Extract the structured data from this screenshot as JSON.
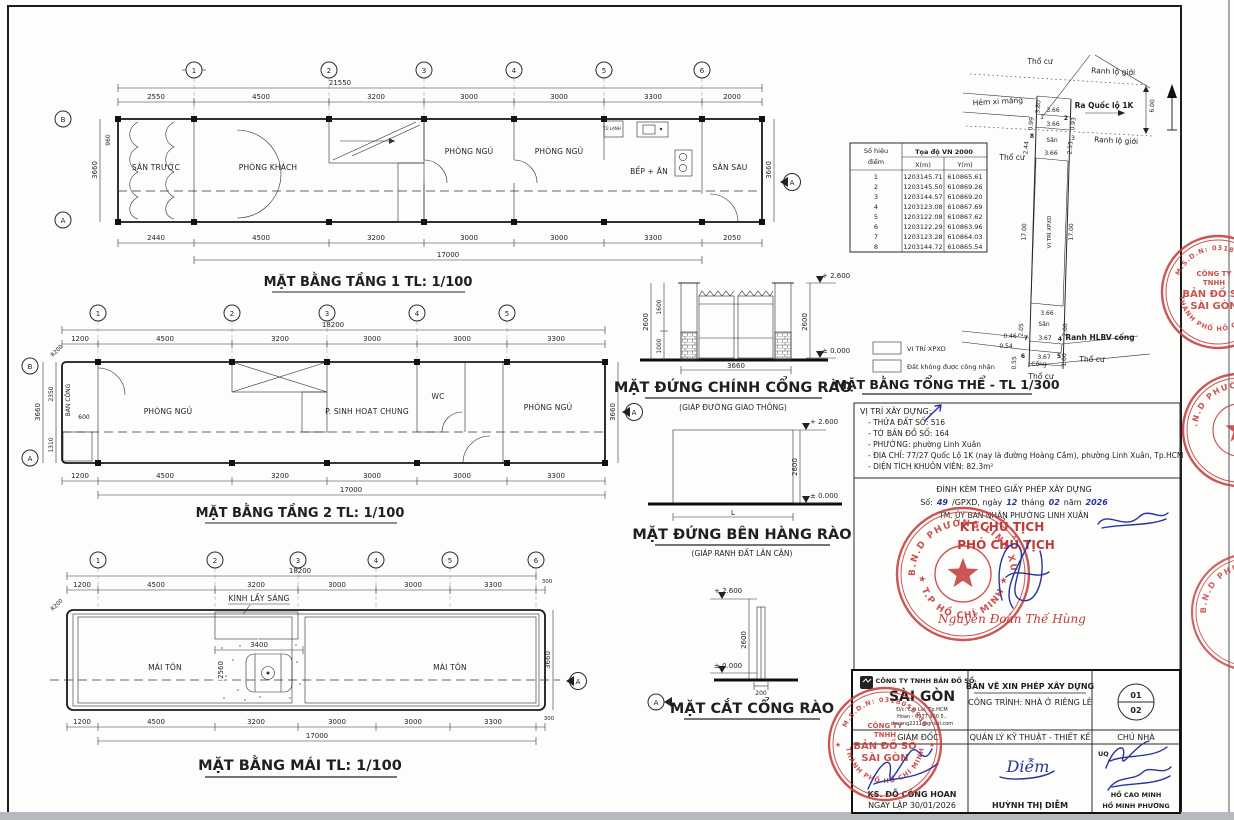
{
  "colors": {
    "stamp_red": "#c43f3f",
    "ink_blue": "#27349b",
    "paper": "#fdfdfb"
  },
  "plan1": {
    "title": "MẶT BẰNG TẦNG 1 TL: 1/100",
    "grid": [
      "1",
      "2",
      "3",
      "4",
      "5",
      "6"
    ],
    "left_bubbles": [
      "B",
      "A"
    ],
    "marker": "A",
    "overall_top": "21550",
    "dims_top": [
      "2550",
      "4500",
      "3200",
      "3000",
      "3000",
      "3300",
      "2000"
    ],
    "dims_bottom": [
      "2440",
      "4500",
      "3200",
      "3000",
      "3000",
      "3300",
      "2050"
    ],
    "overall_bottom": "17000",
    "dim_left_outer": "3660",
    "dim_left_inner": "960",
    "dim_right": "3660",
    "rooms": {
      "front_yard": "SÂN TRƯỚC",
      "living": "PHÒNG KHÁCH",
      "bed1": "PHÒNG NGỦ",
      "bed2": "PHÒNG NGỦ",
      "kitchen": "BẾP + ĂN",
      "back_yard": "SÂN SAU",
      "fridge": "TỦ LẠNH"
    }
  },
  "plan2": {
    "title": "MẶT BẰNG TẦNG 2 TL: 1/100",
    "grid": [
      "1",
      "2",
      "3",
      "4",
      "5"
    ],
    "left_bubbles": [
      "B",
      "A"
    ],
    "marker": "A",
    "overall_top": "18200",
    "dims_top": [
      "1200",
      "4500",
      "3200",
      "3000",
      "3000",
      "3300"
    ],
    "dims_bottom": [
      "1200",
      "4500",
      "3200",
      "3000",
      "3000",
      "3300"
    ],
    "overall_bottom": "17000",
    "dim_left_outer": "3660",
    "dim_left_a": "2350",
    "dim_left_b": "1310",
    "dim_600": "600",
    "r200": "R200",
    "dim_right": "3660",
    "rooms": {
      "balcony": "BAN CÔNG",
      "bed1": "PHÒNG NGỦ",
      "common": "P. SINH HOẠT CHUNG",
      "wc": "WC",
      "bed2": "PHÒNG NGỦ"
    }
  },
  "roof": {
    "title": "MẶT BẰNG MÁI TL: 1/100",
    "grid": [
      "1",
      "2",
      "3",
      "4",
      "5",
      "6"
    ],
    "marker": "A",
    "overall_top": "18200",
    "dims_top": [
      "1200",
      "4500",
      "3200",
      "3000",
      "3000",
      "3300",
      "300"
    ],
    "dims_bottom": [
      "1200",
      "4500",
      "3200",
      "3000",
      "3000",
      "3300",
      "300"
    ],
    "overall_bottom": "17000",
    "d3400": "3400",
    "d2560": "2560",
    "dim_right": "3660",
    "r200": "R200",
    "skylight": "KÍNH LẤY SÁNG",
    "mt_left": "MÁI TÔN",
    "mt_right": "MÁI TÔN"
  },
  "gate_front": {
    "title": "MẶT ĐỨNG CHÍNH CỔNG RÀO",
    "subtitle": "(GIÁP ĐƯỜNG GIAO THÔNG)",
    "lvl_top": "+ 2.600",
    "lvl_zero": "± 0.000",
    "d2600l": "2600",
    "d1600": "1600",
    "d1000": "1000",
    "d3660": "3660",
    "d2600r": "2600"
  },
  "fence_side": {
    "title": "MẶT ĐỨNG BÊN HÀNG RÀO",
    "subtitle": "(GIÁP RANH ĐẤT LÂN CẬN)",
    "lvl_top": "+ 2.600",
    "lvl_zero": "± 0.000",
    "d2600": "2600",
    "dL": "L"
  },
  "gate_section": {
    "title": "MẶT CẮT CỔNG RÀO",
    "lvl_top": "+ 2.600",
    "lvl_zero": "± 0.000",
    "d2600": "2600",
    "d200": "200"
  },
  "site": {
    "title": "MẶT BẰNG TỔNG THỂ - TL 1/300",
    "table": {
      "h_point": "Số hiệu",
      "h_point2": "điểm",
      "h_coord": "Tọa độ VN 2000",
      "h_x": "X(m)",
      "h_y": "Y(m)",
      "rows": [
        [
          "1",
          "1203145.71",
          "610865.61"
        ],
        [
          "2",
          "1203145.50",
          "610869.26"
        ],
        [
          "3",
          "1203144.57",
          "610869.20"
        ],
        [
          "4",
          "1203123.08",
          "610867.69"
        ],
        [
          "5",
          "1203122.08",
          "610867.62"
        ],
        [
          "6",
          "1203122.29",
          "610863.96"
        ],
        [
          "7",
          "1203123.28",
          "610864.03"
        ],
        [
          "8",
          "1203144.72",
          "610865.54"
        ]
      ]
    },
    "labels": {
      "tho_cu_top": "Thổ cư",
      "tho_cu_left": "Thổ cư",
      "tho_cu_bottom": "Thổ cư",
      "tho_cu_br": "Thổ cư",
      "ranh1": "Ranh lộ giới",
      "ranh2": "Ranh lộ giới",
      "hem": "Hẻm xi măng",
      "ra_ql": "Ra Quốc lộ 1K",
      "san_top": "Sân",
      "san_bottom": "Sân",
      "cong": "Cống",
      "ranh_hlbv": "Ranh HLBV cống",
      "xpxd_strip": "VI TRÍ XPXD"
    },
    "dims": {
      "d380": "3.80",
      "d366a": "3.66",
      "d366b": "3.66",
      "d366c": "3.66",
      "d366d": "3.66",
      "d099": "0.99",
      "d093": "0.93",
      "d244": "2.44",
      "d255": "2.55",
      "d600": "6.00",
      "d1700l": "17.00",
      "d1700r": "17.00",
      "d205": "2.05",
      "d200": "2.00",
      "d046": "0.46",
      "d367a": "3.67",
      "d054": "0.54",
      "d367b": "3.67",
      "d055": "0.55",
      "d100": "1.00"
    },
    "points": {
      "p1": "1",
      "p2": "2",
      "p3": "3",
      "p8": "8",
      "p7": "7",
      "p4": "4",
      "p6": "6",
      "p5": "5"
    },
    "legend": {
      "xpxd": "VI TRÍ XPXD",
      "no_recog": "Đất không được công nhận"
    }
  },
  "info": {
    "heading": "VỊ TRÍ XÂY DỰNG:",
    "l1": "- THỬA ĐẤT SỐ: 516",
    "l2": "- TỜ BẢN ĐỒ SỐ: 164",
    "l3": "- PHƯỜNG: phường Linh Xuân",
    "l4": "- ĐỊA CHỈ: 77/27 Quốc Lộ 1K (nay là đường Hoàng Cầm), phường Linh Xuân, Tp.HCM",
    "l5": "- DIỆN TÍCH KHUÔN VIÊN: 82.3m²"
  },
  "permit": {
    "l1": "ĐÍNH KÈM THEO GIẤY PHÉP XÂY DỰNG",
    "so": "Số:",
    "num": "49",
    "gpxd": "/GPXD, ngày",
    "day": "12",
    "thang": "tháng",
    "month": "02",
    "nam": "năm",
    "year": "2026",
    "l3": "TM. ỦY BAN NHÂN PHƯỜNG LINH XUÂN",
    "kt": "KT.CHỦ TỊCH",
    "pct": "PHÓ CHỦ TỊCH",
    "signer": "Nguyễn Đoàn Thế Hùng"
  },
  "ward_stamp": {
    "top": "U.B.N.D PHƯỜNG LINH XUÂN",
    "bottom": "★ T.P HỒ CHÍ MINH ★"
  },
  "company_stamp": {
    "msdn": "M.S.D.N: 0318055936",
    "city": "THÀNH PHỐ HỒ CHÍ MINH",
    "c1": "CÔNG TY",
    "c2": "TNHH",
    "c3": "BẢN ĐỒ SỐ",
    "c4": "SÀI GÒN"
  },
  "titleblock": {
    "company1": "CÔNG TY TNHH BẢN ĐỒ SỐ",
    "company2": "SÀI GÒN",
    "addr1": "Đ/c: Cát Lái, Tp.HCM",
    "addr2": "Hoan - 0977 960 5..",
    "addr3": "docong2211@gmail.com",
    "doc": "BẢN VẼ XIN PHÉP XÂY DỰNG",
    "project": "CÔNG TRÌNH: NHÀ Ở RIÊNG LẺ",
    "page1": "01",
    "page2": "02",
    "role1": "GIÁM ĐỐC",
    "role2": "QUẢN LÝ KỸ THUẬT - THIẾT KẾ",
    "role3": "CHỦ NHÀ",
    "uq": "UQ",
    "sig2": "Diễm",
    "n1a": "KS. ĐỖ CÔNG HOAN",
    "n1b": "NGÀY LẬP 30/01/2026",
    "n2": "HUỲNH THỊ DIỄM",
    "n3a": "HỒ CAO MINH",
    "n3b": "HỒ MINH PHƯƠNG"
  }
}
